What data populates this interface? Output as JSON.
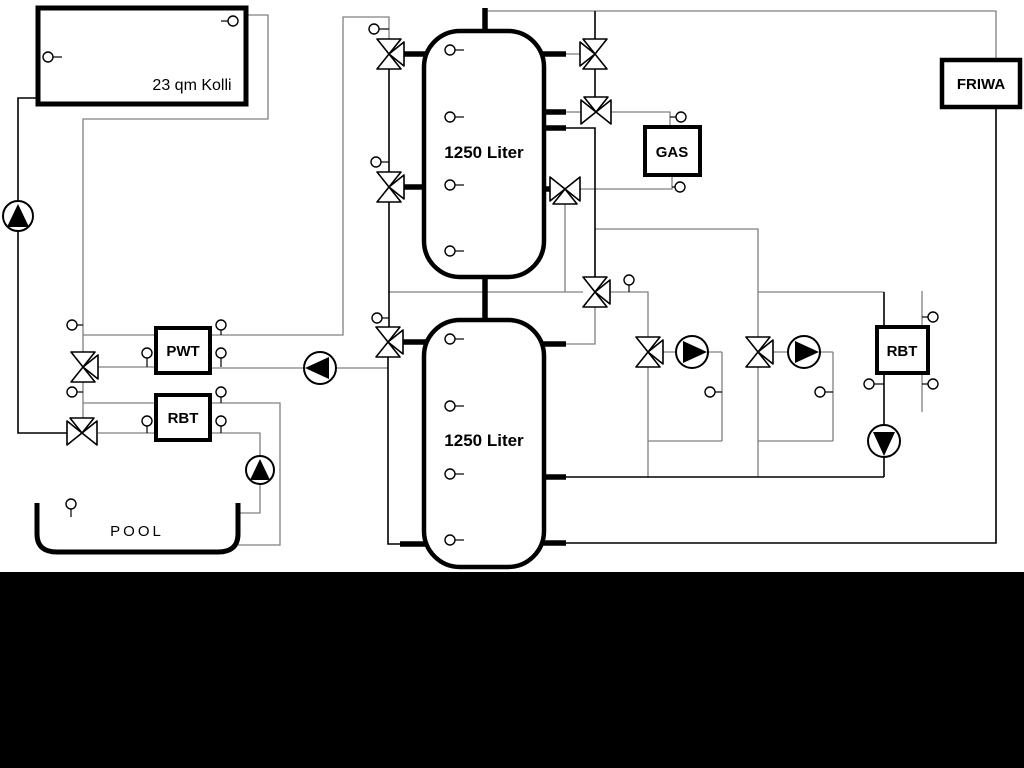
{
  "labels": {
    "collector": "23 qm Kolli",
    "tank_top": "1250 Liter",
    "tank_bottom": "1250 Liter",
    "pwt": "PWT",
    "rbt_left": "RBT",
    "rbt_right": "RBT",
    "gas": "GAS",
    "friwa": "FRIWA",
    "pool": "POOL"
  },
  "colors": {
    "pipe_gray": "#808080",
    "pipe_black": "#000000",
    "canvas_background": "#ffffff",
    "letterbox_band": "#000000"
  }
}
